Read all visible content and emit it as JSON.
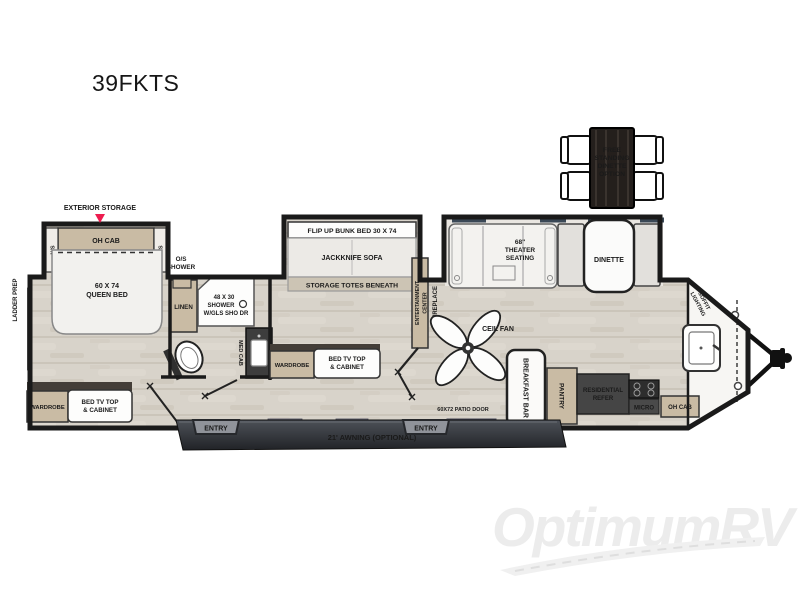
{
  "title": "39FKTS",
  "watermark": "OptimumRV",
  "colors": {
    "wall": "#1a1a1a",
    "floor": "#d8d3ca",
    "cabinet_tan": "#c9bba4",
    "accent_red": "#ed1c4f",
    "awning_dark": "#212327",
    "appliance_dark": "#454545",
    "watermark_gray": "#ececec"
  },
  "exterior": {
    "storage_label": "EXTERIOR STORAGE",
    "ladder_prep": "LADDER PREP",
    "awning": "21' AWNING (OPTIONAL)",
    "entry_left": "ENTRY",
    "entry_right": "ENTRY",
    "patio_door": "60X72 PATIO DOOR",
    "soffit_l1": "SOFFIT",
    "soffit_l2": "LIGHTING"
  },
  "bedroom": {
    "oh_cab": "OH CAB",
    "ns_left": "N/S",
    "ns_right": "N/S",
    "bed_l1": "60 X 74",
    "bed_l2": "QUEEN BED",
    "wardrobe": "WARDROBE",
    "tv_l1": "BED TV TOP",
    "tv_l2": "& CABINET"
  },
  "bathroom": {
    "os_shower_l1": "O/S",
    "os_shower_l2": "SHOWER",
    "linen": "LINEN",
    "shower_l1": "48 X 30",
    "shower_l2": "SHOWER",
    "shower_l3": "W/GLS SHO DR",
    "med_cab": "MED CAB"
  },
  "bunk_room": {
    "bunk": "FLIP UP BUNK BED 30 X 74",
    "sofa": "JACKKNIFE SOFA",
    "totes": "STORAGE TOTES BENEATH",
    "wardrobe": "WARDROBE",
    "tv_l1": "BED TV TOP",
    "tv_l2": "& CABINET"
  },
  "living": {
    "ent_l1": "ENTERTAINMENT",
    "ent_l2": "CENTER",
    "fireplace": "FIREPLACE",
    "ceil_fan": "CEIL FAN",
    "theater_l1": "68\"",
    "theater_l2": "THEATER",
    "theater_l3": "SEATING",
    "dinette": "DINETTE"
  },
  "dinette_option": {
    "l1": "FREE",
    "l2": "STANDING",
    "l3": "DINETTE",
    "l4": "OPTION"
  },
  "kitchen": {
    "breakfast_bar": "BREAKFAST BAR",
    "pantry": "PANTRY",
    "refer_l1": "RESIDENTIAL",
    "refer_l2": "REFER",
    "micro": "MICRO",
    "oh_cab": "OH CAB"
  }
}
